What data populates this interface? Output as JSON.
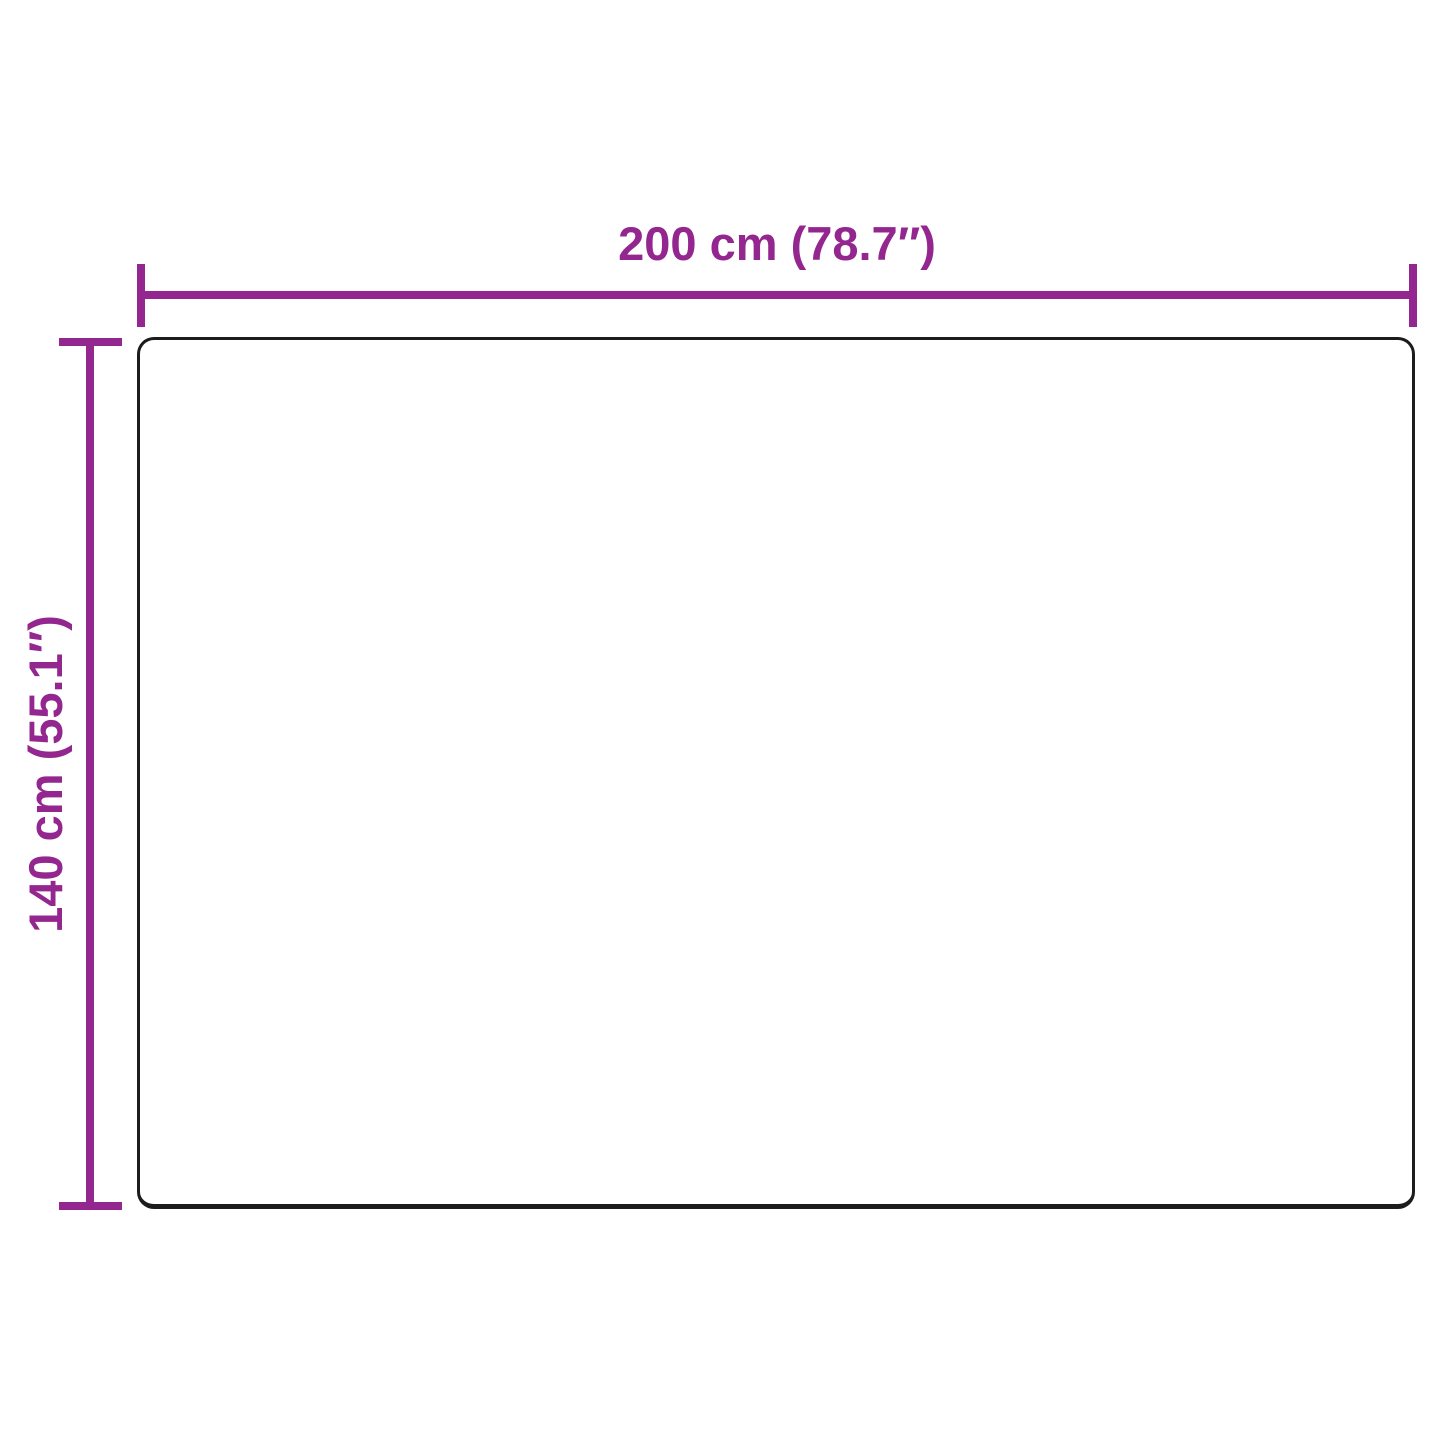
{
  "diagram": {
    "width_label": "200 cm (78.7″)",
    "height_label": "140 cm (55.1″)"
  },
  "dimensions": {
    "width": {
      "cm": "200",
      "inches": "78.7"
    },
    "height": {
      "cm": "140",
      "inches": "55.1"
    }
  },
  "colors": {
    "accent": "#93278F",
    "outline": "#1C1C1C",
    "background": "#FFFFFF"
  }
}
